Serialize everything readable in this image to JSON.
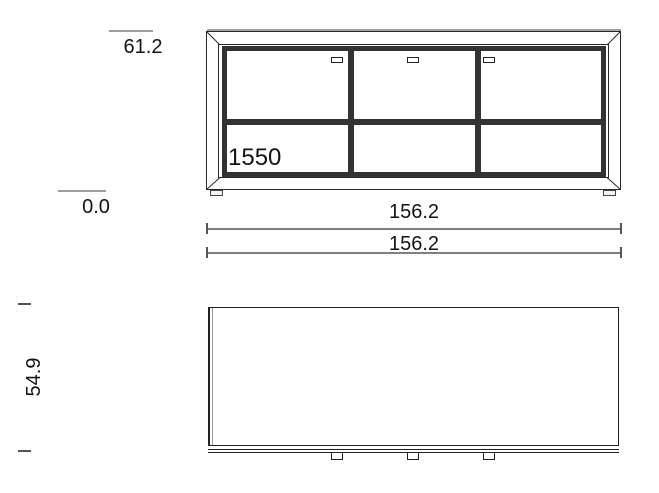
{
  "drawing": {
    "title": "sideboard technical drawing, front and plan view",
    "views": {
      "front": {
        "model_label": "1550",
        "door_count": 3,
        "handle_count": 3
      },
      "plan": {
        "tab_count": 3
      }
    },
    "dimensions": {
      "height_top": "61.2",
      "height_base": "0.0",
      "width_outer": "156.2",
      "width_inner": "156.2",
      "depth": "54.9"
    },
    "colors": {
      "outline": "#2a2a2a",
      "frame_band": "#333333",
      "top_edge_gray": "#a2a2a2",
      "dim_tick_gray": "#9c9c9c",
      "dim_line_gray": "#7f7f7f",
      "text": "#141414"
    }
  }
}
